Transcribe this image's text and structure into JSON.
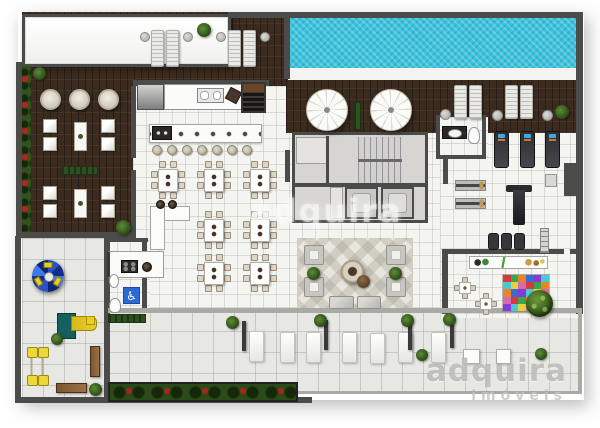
{
  "meta": {
    "description": "Top-down rendered architectural floor plan of a residential leisure / amenities level",
    "view": "top-down floor plan"
  },
  "watermark": {
    "center_text": "adquira",
    "logo_text": "adquira",
    "logo_subtext": "imóveis"
  },
  "palette": {
    "background": "#ffffff",
    "wood_deck": "#3b2b1e",
    "pool_water": "#3cc4dc",
    "indoor_tile": "#f4f4f1",
    "terrace_tile": "#e7e7e3",
    "wall": "#4b4b49",
    "greenery": "#33511d",
    "flowers": "#a8241c",
    "accessible_sign_blue": "#2a6ad4",
    "play_yellow": "#e8ce20",
    "play_teal": "#15605e",
    "kids_mat": [
      "#d43a3a",
      "#3a6bd4",
      "#e8d23a",
      "#3aa54a",
      "#8a3ad4",
      "#d46bb0",
      "#e8832a",
      "#4ac8d4"
    ],
    "carousel_blues": [
      "#2a52c8",
      "#122e86",
      "#3e78e8",
      "#0e2670"
    ]
  },
  "areas": [
    {
      "name": "swimming-pool"
    },
    {
      "name": "pool-sun-deck"
    },
    {
      "name": "pergola"
    },
    {
      "name": "left-lounge-deck"
    },
    {
      "name": "gourmet-kitchen"
    },
    {
      "name": "bar-counter"
    },
    {
      "name": "dining-hall"
    },
    {
      "name": "buffet"
    },
    {
      "name": "stair-core"
    },
    {
      "name": "elevators"
    },
    {
      "name": "gym"
    },
    {
      "name": "gym-bathroom"
    },
    {
      "name": "kids-playroom"
    },
    {
      "name": "indoor-lounge"
    },
    {
      "name": "accessible-wc"
    },
    {
      "name": "support-kitchen"
    },
    {
      "name": "playground"
    },
    {
      "name": "terrace"
    },
    {
      "name": "flower-beds"
    }
  ],
  "floorplan": {
    "objects": [
      {
        "t": "lounger",
        "x": 151,
        "y": 30,
        "w": 13,
        "h": 37
      },
      {
        "t": "lounger",
        "x": 166,
        "y": 30,
        "w": 13,
        "h": 37
      },
      {
        "t": "lounger",
        "x": 228,
        "y": 30,
        "w": 13,
        "h": 37
      },
      {
        "t": "lounger",
        "x": 243,
        "y": 30,
        "w": 13,
        "h": 37
      },
      {
        "t": "sidetable",
        "x": 140,
        "y": 32,
        "w": 10,
        "h": 10
      },
      {
        "t": "sidetable",
        "x": 183,
        "y": 32,
        "w": 10,
        "h": 10
      },
      {
        "t": "sidetable",
        "x": 216,
        "y": 32,
        "w": 10,
        "h": 10
      },
      {
        "t": "sidetable",
        "x": 260,
        "y": 32,
        "w": 10,
        "h": 10
      },
      {
        "t": "plant",
        "x": 197,
        "y": 23,
        "w": 14,
        "h": 14
      },
      {
        "t": "plant",
        "x": 33,
        "y": 67,
        "w": 13,
        "h": 13
      },
      {
        "t": "umbrella",
        "x": 306,
        "y": 89,
        "w": 42,
        "h": 42
      },
      {
        "t": "umbrella",
        "x": 370,
        "y": 89,
        "w": 42,
        "h": 42
      },
      {
        "t": "planter",
        "x": 353,
        "y": 102,
        "w": 8,
        "h": 28
      },
      {
        "t": "lounger",
        "x": 454,
        "y": 85,
        "w": 13,
        "h": 34
      },
      {
        "t": "lounger",
        "x": 469,
        "y": 85,
        "w": 13,
        "h": 34
      },
      {
        "t": "lounger",
        "x": 505,
        "y": 85,
        "w": 13,
        "h": 34
      },
      {
        "t": "lounger",
        "x": 520,
        "y": 85,
        "w": 13,
        "h": 34
      },
      {
        "t": "sidetable",
        "x": 440,
        "y": 109,
        "w": 11,
        "h": 11
      },
      {
        "t": "sidetable",
        "x": 492,
        "y": 110,
        "w": 11,
        "h": 11
      },
      {
        "t": "sidetable",
        "x": 542,
        "y": 110,
        "w": 11,
        "h": 11
      },
      {
        "t": "plant",
        "x": 555,
        "y": 105,
        "w": 14,
        "h": 14
      },
      {
        "t": "roundtable",
        "x": 40,
        "y": 89,
        "w": 21,
        "h": 21
      },
      {
        "t": "roundtable",
        "x": 69,
        "y": 89,
        "w": 21,
        "h": 21
      },
      {
        "t": "roundtable",
        "x": 98,
        "y": 89,
        "w": 21,
        "h": 21
      },
      {
        "t": "seat",
        "x": 43,
        "y": 119,
        "w": 14,
        "h": 14
      },
      {
        "t": "seat",
        "x": 43,
        "y": 137,
        "w": 14,
        "h": 14
      },
      {
        "t": "seat",
        "x": 101,
        "y": 119,
        "w": 14,
        "h": 14
      },
      {
        "t": "seat",
        "x": 101,
        "y": 137,
        "w": 14,
        "h": 14
      },
      {
        "t": "decktable",
        "x": 74,
        "y": 122,
        "w": 13,
        "h": 29
      },
      {
        "t": "planter",
        "x": 61,
        "y": 166,
        "w": 37,
        "h": 9
      },
      {
        "t": "seat",
        "x": 43,
        "y": 186,
        "w": 14,
        "h": 14
      },
      {
        "t": "seat",
        "x": 43,
        "y": 204,
        "w": 14,
        "h": 14
      },
      {
        "t": "seat",
        "x": 101,
        "y": 186,
        "w": 14,
        "h": 14
      },
      {
        "t": "seat",
        "x": 101,
        "y": 204,
        "w": 14,
        "h": 14
      },
      {
        "t": "decktable",
        "x": 74,
        "y": 189,
        "w": 13,
        "h": 29
      },
      {
        "t": "plant",
        "x": 116,
        "y": 220,
        "w": 15,
        "h": 15
      },
      {
        "t": "fridge",
        "x": 137,
        "y": 84,
        "w": 27,
        "h": 26
      },
      {
        "t": "counter",
        "x": 164,
        "y": 84,
        "w": 79,
        "h": 26
      },
      {
        "t": "sink2",
        "x": 197,
        "y": 88,
        "w": 27,
        "h": 15
      },
      {
        "t": "tray",
        "x": 227,
        "y": 89,
        "w": 13,
        "h": 13,
        "r": 28
      },
      {
        "t": "grill",
        "x": 241,
        "y": 82,
        "w": 25,
        "h": 31
      },
      {
        "t": "barcounter",
        "x": 149,
        "y": 124,
        "w": 113,
        "h": 19
      },
      {
        "t": "coffeemachine",
        "x": 152,
        "y": 126,
        "w": 20,
        "h": 14
      },
      {
        "t": "barstool",
        "x": 152,
        "y": 145,
        "w": 10,
        "h": 10
      },
      {
        "t": "barstool",
        "x": 167,
        "y": 145,
        "w": 10,
        "h": 10
      },
      {
        "t": "barstool",
        "x": 182,
        "y": 145,
        "w": 10,
        "h": 10
      },
      {
        "t": "barstool",
        "x": 197,
        "y": 145,
        "w": 10,
        "h": 10
      },
      {
        "t": "barstool",
        "x": 212,
        "y": 145,
        "w": 10,
        "h": 10
      },
      {
        "t": "barstool",
        "x": 227,
        "y": 145,
        "w": 10,
        "h": 10
      },
      {
        "t": "barstool",
        "x": 242,
        "y": 145,
        "w": 10,
        "h": 10
      },
      {
        "t": "dining8",
        "x": 151,
        "y": 161,
        "w": 34,
        "h": 38
      },
      {
        "t": "dining8",
        "x": 197,
        "y": 161,
        "w": 34,
        "h": 38
      },
      {
        "t": "dining8",
        "x": 243,
        "y": 161,
        "w": 34,
        "h": 38
      },
      {
        "t": "dining8",
        "x": 197,
        "y": 211,
        "w": 34,
        "h": 38
      },
      {
        "t": "dining8",
        "x": 243,
        "y": 211,
        "w": 34,
        "h": 38
      },
      {
        "t": "dining8",
        "x": 197,
        "y": 254,
        "w": 34,
        "h": 38
      },
      {
        "t": "dining8",
        "x": 243,
        "y": 254,
        "w": 34,
        "h": 38
      },
      {
        "t": "buffet",
        "x": 150,
        "y": 206,
        "w": 38,
        "h": 42
      },
      {
        "t": "pot",
        "x": 156,
        "y": 200,
        "w": 9,
        "h": 9
      },
      {
        "t": "pot",
        "x": 168,
        "y": 200,
        "w": 9,
        "h": 9
      },
      {
        "t": "counter2",
        "x": 107,
        "y": 251,
        "w": 57,
        "h": 27
      },
      {
        "t": "stove",
        "x": 121,
        "y": 260,
        "w": 17,
        "h": 13
      },
      {
        "t": "pot",
        "x": 142,
        "y": 262,
        "w": 10,
        "h": 10
      },
      {
        "t": "sinkoval",
        "x": 109,
        "y": 274,
        "w": 10,
        "h": 14
      },
      {
        "t": "accessible",
        "x": 123,
        "y": 287,
        "w": 17,
        "h": 17
      },
      {
        "t": "toilet",
        "x": 109,
        "y": 298,
        "w": 12,
        "h": 15
      },
      {
        "t": "vanity",
        "x": 442,
        "y": 126,
        "w": 25,
        "h": 13
      },
      {
        "t": "toilet",
        "x": 468,
        "y": 127,
        "w": 12,
        "h": 17
      },
      {
        "t": "treadmill",
        "x": 494,
        "y": 131,
        "w": 15,
        "h": 37
      },
      {
        "t": "treadmill",
        "x": 520,
        "y": 131,
        "w": 15,
        "h": 37
      },
      {
        "t": "treadmill",
        "x": 545,
        "y": 131,
        "w": 15,
        "h": 37
      },
      {
        "t": "weightbench",
        "x": 455,
        "y": 180,
        "w": 31,
        "h": 11
      },
      {
        "t": "weightbench",
        "x": 455,
        "y": 198,
        "w": 31,
        "h": 11
      },
      {
        "t": "multigym",
        "x": 506,
        "y": 185,
        "w": 26,
        "h": 37
      },
      {
        "t": "mat",
        "x": 488,
        "y": 233,
        "w": 11,
        "h": 17
      },
      {
        "t": "mat",
        "x": 501,
        "y": 233,
        "w": 11,
        "h": 17
      },
      {
        "t": "mat",
        "x": 514,
        "y": 233,
        "w": 11,
        "h": 17
      },
      {
        "t": "wallbars",
        "x": 540,
        "y": 228,
        "w": 9,
        "h": 25
      },
      {
        "t": "storagebox",
        "x": 545,
        "y": 174,
        "w": 12,
        "h": 13
      },
      {
        "t": "toyshelf",
        "x": 469,
        "y": 256,
        "w": 79,
        "h": 13
      },
      {
        "t": "kidmat",
        "x": 502,
        "y": 274,
        "w": 48,
        "h": 38
      },
      {
        "t": "gametable4",
        "x": 454,
        "y": 277,
        "w": 22,
        "h": 22
      },
      {
        "t": "gametable4",
        "x": 475,
        "y": 293,
        "w": 22,
        "h": 22
      },
      {
        "t": "pompon",
        "x": 526,
        "y": 290,
        "w": 27,
        "h": 27
      },
      {
        "t": "armchair",
        "x": 304,
        "y": 245,
        "w": 20,
        "h": 20
      },
      {
        "t": "armchair",
        "x": 304,
        "y": 277,
        "w": 20,
        "h": 20
      },
      {
        "t": "armchair",
        "x": 386,
        "y": 245,
        "w": 20,
        "h": 20
      },
      {
        "t": "armchair",
        "x": 386,
        "y": 277,
        "w": 20,
        "h": 20
      },
      {
        "t": "plant",
        "x": 307,
        "y": 267,
        "w": 13,
        "h": 13
      },
      {
        "t": "plant",
        "x": 389,
        "y": 267,
        "w": 13,
        "h": 13
      },
      {
        "t": "firepit",
        "x": 341,
        "y": 260,
        "w": 23,
        "h": 23
      },
      {
        "t": "pouf",
        "x": 357,
        "y": 275,
        "w": 13,
        "h": 13
      },
      {
        "t": "ottoman",
        "x": 329,
        "y": 296,
        "w": 25,
        "h": 13
      },
      {
        "t": "ottoman",
        "x": 357,
        "y": 296,
        "w": 24,
        "h": 13
      },
      {
        "t": "daybed",
        "x": 249,
        "y": 331,
        "w": 15,
        "h": 31
      },
      {
        "t": "daybed",
        "x": 280,
        "y": 332,
        "w": 15,
        "h": 31
      },
      {
        "t": "daybed",
        "x": 306,
        "y": 332,
        "w": 15,
        "h": 31
      },
      {
        "t": "daybed",
        "x": 342,
        "y": 332,
        "w": 15,
        "h": 31
      },
      {
        "t": "daybed",
        "x": 370,
        "y": 333,
        "w": 15,
        "h": 31
      },
      {
        "t": "daybed",
        "x": 398,
        "y": 332,
        "w": 15,
        "h": 31
      },
      {
        "t": "daybed",
        "x": 431,
        "y": 332,
        "w": 15,
        "h": 31
      },
      {
        "t": "tablesq",
        "x": 463,
        "y": 349,
        "w": 17,
        "h": 15
      },
      {
        "t": "tablesq",
        "x": 496,
        "y": 349,
        "w": 15,
        "h": 15
      },
      {
        "t": "screen",
        "x": 242,
        "y": 321,
        "w": 4,
        "h": 30
      },
      {
        "t": "screen",
        "x": 324,
        "y": 320,
        "w": 4,
        "h": 30
      },
      {
        "t": "screen",
        "x": 408,
        "y": 320,
        "w": 4,
        "h": 30
      },
      {
        "t": "screen",
        "x": 450,
        "y": 318,
        "w": 4,
        "h": 30
      },
      {
        "t": "plant",
        "x": 226,
        "y": 316,
        "w": 13,
        "h": 13
      },
      {
        "t": "plant",
        "x": 314,
        "y": 314,
        "w": 13,
        "h": 13
      },
      {
        "t": "plant",
        "x": 401,
        "y": 314,
        "w": 13,
        "h": 13
      },
      {
        "t": "plant",
        "x": 443,
        "y": 313,
        "w": 13,
        "h": 13
      },
      {
        "t": "plant",
        "x": 416,
        "y": 349,
        "w": 12,
        "h": 12
      },
      {
        "t": "plant",
        "x": 535,
        "y": 348,
        "w": 12,
        "h": 12
      },
      {
        "t": "carousel",
        "x": 32,
        "y": 260,
        "w": 32,
        "h": 32
      },
      {
        "t": "playset",
        "x": 57,
        "y": 309,
        "w": 40,
        "h": 36
      },
      {
        "t": "seesaw",
        "x": 26,
        "y": 347,
        "w": 11,
        "h": 39
      },
      {
        "t": "seesaw",
        "x": 37,
        "y": 347,
        "w": 11,
        "h": 39
      },
      {
        "t": "benchwood",
        "x": 56,
        "y": 383,
        "w": 31,
        "h": 10
      },
      {
        "t": "benchwood",
        "x": 90,
        "y": 346,
        "w": 10,
        "h": 31
      },
      {
        "t": "plant",
        "x": 89,
        "y": 383,
        "w": 13,
        "h": 13
      },
      {
        "t": "plant",
        "x": 51,
        "y": 333,
        "w": 12,
        "h": 12
      },
      {
        "t": "toybox",
        "x": 86,
        "y": 316,
        "w": 9,
        "h": 9
      },
      {
        "t": "hedge",
        "x": 108,
        "y": 314,
        "w": 38,
        "h": 9
      }
    ]
  }
}
